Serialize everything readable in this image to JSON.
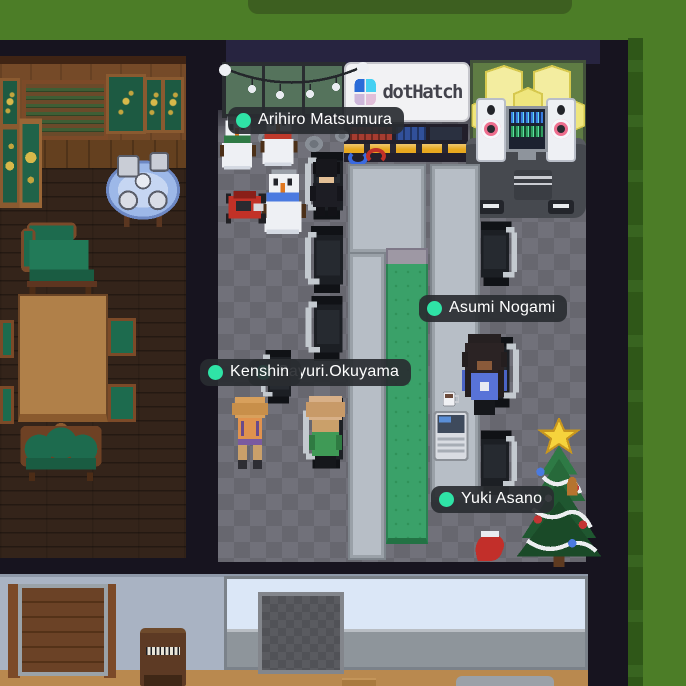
{
  "map": {
    "kind": "virtual-office-floor",
    "sign": {
      "brand": "dotHatch"
    },
    "players": [
      {
        "name": "Arihiro Matsumura"
      },
      {
        "name": "Kenshin"
      },
      {
        "name": "Sayuri.Okuyama"
      },
      {
        "name": "Asumi Nogami"
      },
      {
        "name": "Yuki Asano"
      }
    ],
    "presence": {
      "status_dot_color": "#2fe3a6"
    },
    "colors": {
      "grass": "#4c7d27",
      "wall": "#17141f",
      "office_floor": "#6c6c73",
      "meeting_table_green": "#3aa169",
      "tag_background": "rgba(41,44,49,0.92)",
      "sign_logo_blue": "#2a6bd8",
      "sign_logo_cyan": "#45d0f2"
    }
  }
}
